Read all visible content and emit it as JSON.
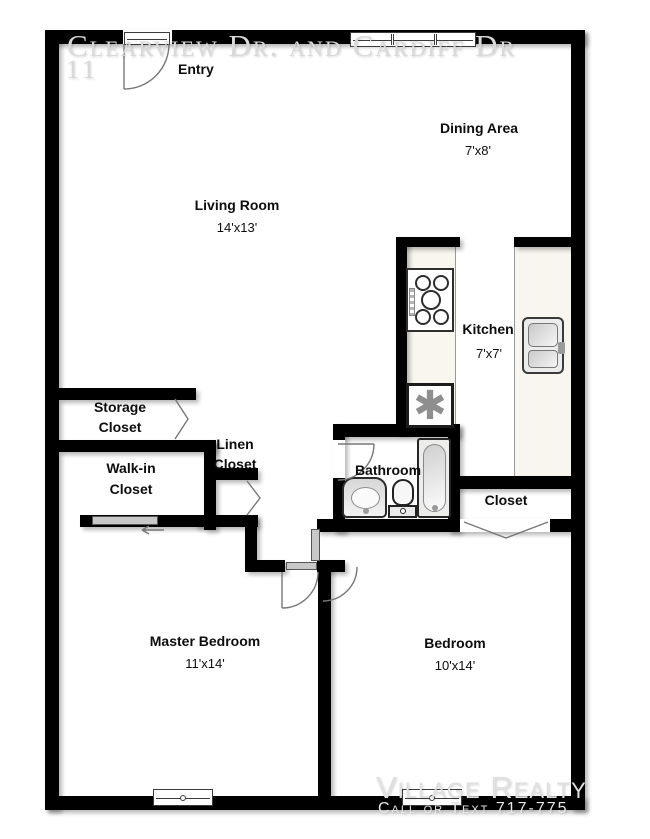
{
  "watermarks": {
    "top_line1": "Clearview Dr. and Cardiff Dr",
    "top_line2": "11",
    "bottom_line1": "Village Realty",
    "bottom_line2": "Call or Text 717-775"
  },
  "rooms": {
    "entry": {
      "label": "Entry"
    },
    "dining_area": {
      "label": "Dining Area",
      "dims": "7'x8'"
    },
    "living_room": {
      "label": "Living Room",
      "dims": "14'x13'"
    },
    "kitchen": {
      "label": "Kitchen",
      "dims": "7'x7'"
    },
    "storage_closet": {
      "line1": "Storage",
      "line2": "Closet"
    },
    "walk_in_closet": {
      "line1": "Walk-in",
      "line2": "Closet"
    },
    "linen_closet": {
      "line1": "Linen",
      "line2": "Closet"
    },
    "bathroom": {
      "label": "Bathroom"
    },
    "closet": {
      "label": "Closet"
    },
    "master_bedroom": {
      "label": "Master Bedroom",
      "dims": "11'x14'"
    },
    "bedroom": {
      "label": "Bedroom",
      "dims": "10'x14'"
    }
  },
  "fixtures": {
    "appliance_glyph": "✱"
  },
  "colors": {
    "wall": "#000000",
    "counter": "#f8f6ef",
    "door_line": "#777777",
    "watermark": "#d9d9d9"
  }
}
